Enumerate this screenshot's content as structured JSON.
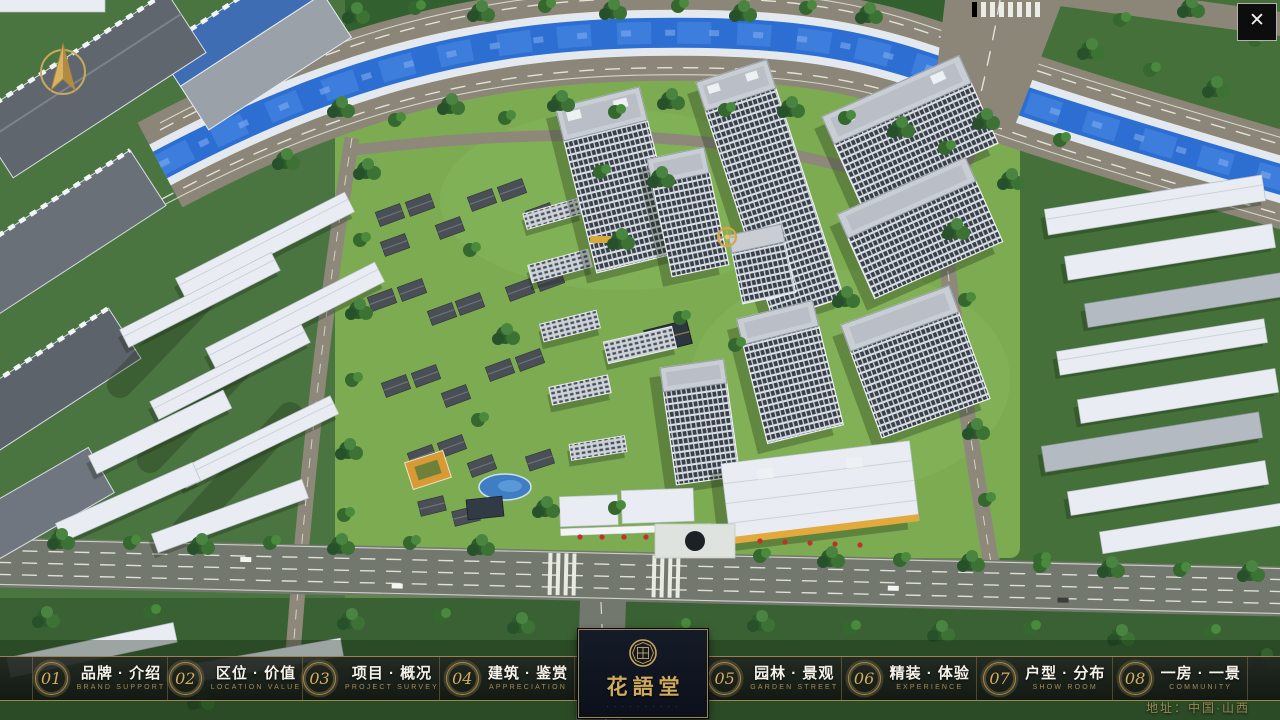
{
  "window": {
    "close_glyph": "✕"
  },
  "compass": {
    "icon": "north-arrow"
  },
  "logo": {
    "name": "花語堂",
    "tagline": "· · · · · · · · · ·"
  },
  "menu": {
    "items": [
      {
        "num": "01",
        "label": "品牌 · 介绍",
        "sub": "BRAND SUPPORT"
      },
      {
        "num": "02",
        "label": "区位 · 价值",
        "sub": "LOCATION VALUE"
      },
      {
        "num": "03",
        "label": "项目 · 概况",
        "sub": "PROJECT SURVEY"
      },
      {
        "num": "04",
        "label": "建筑 · 鉴赏",
        "sub": "APPRECIATION"
      },
      {
        "num": "05",
        "label": "园林 · 景观",
        "sub": "GARDEN STREET"
      },
      {
        "num": "06",
        "label": "精装 · 体验",
        "sub": "EXPERIENCE"
      },
      {
        "num": "07",
        "label": "户型 · 分布",
        "sub": "SHOW ROOM"
      },
      {
        "num": "08",
        "label": "一房 · 一景",
        "sub": "COMMUNITY"
      }
    ]
  },
  "footer": {
    "address": "地址：中国·山西"
  },
  "colors": {
    "gold": "#c9a85c",
    "bar_bg": "#161a17",
    "river": "#2d6ed2",
    "grass": "#7cab52"
  }
}
